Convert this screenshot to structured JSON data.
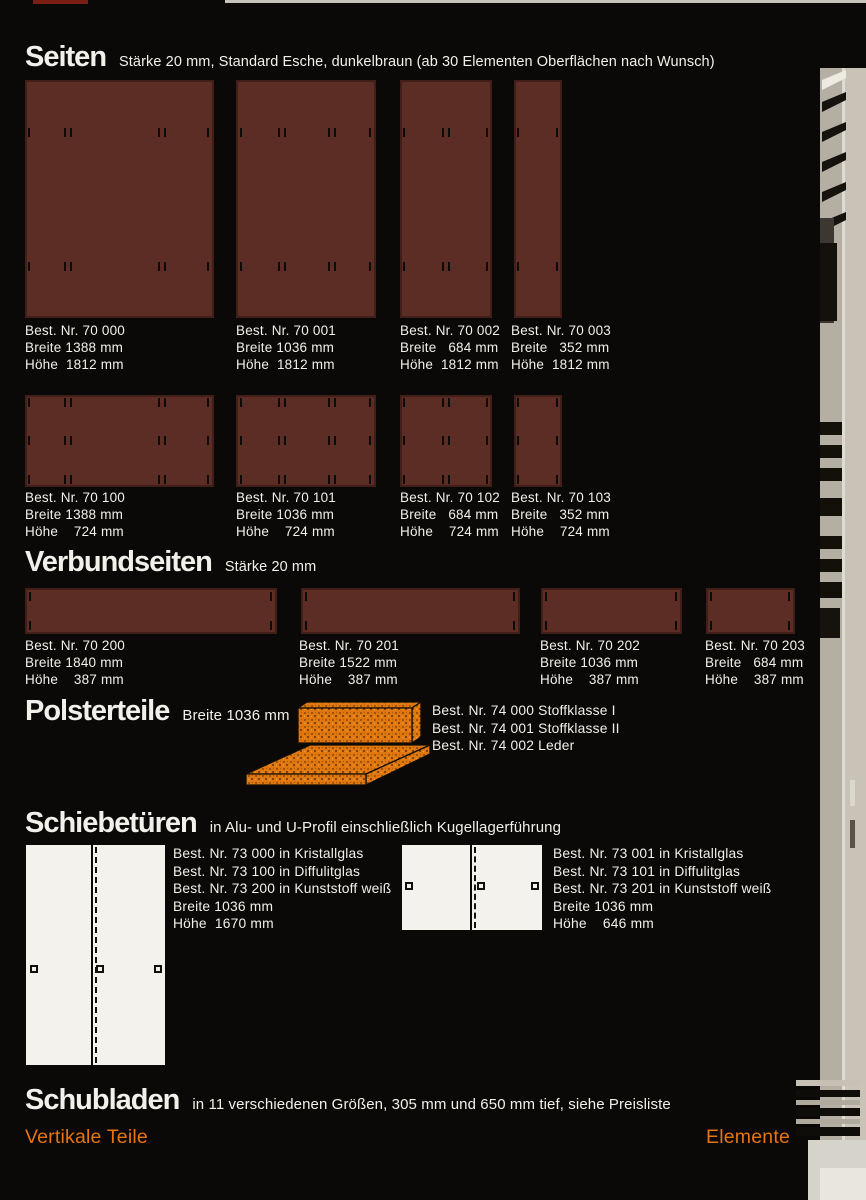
{
  "colors": {
    "background": "#0a0907",
    "panel_brown": "#5b2d24",
    "accent_orange": "#e7740e",
    "text_white": "#f2f0ea",
    "cushion_orange": "#e1780f"
  },
  "seiten": {
    "title": "Seiten",
    "subtitle": "Stärke 20 mm, Standard Esche, dunkelbraun (ab 30 Elementen Oberflächen nach Wunsch)",
    "row1": [
      {
        "nr": "Best. Nr. 70 000",
        "breite": "Breite 1388 mm",
        "hoehe": "Höhe  1812 mm"
      },
      {
        "nr": "Best. Nr. 70 001",
        "breite": "Breite 1036 mm",
        "hoehe": "Höhe  1812 mm"
      },
      {
        "nr": "Best. Nr. 70 002",
        "breite": "Breite   684 mm",
        "hoehe": "Höhe  1812 mm"
      },
      {
        "nr": "Best. Nr. 70 003",
        "breite": "Breite   352 mm",
        "hoehe": "Höhe  1812 mm"
      }
    ],
    "row2": [
      {
        "nr": "Best. Nr. 70 100",
        "breite": "Breite 1388 mm",
        "hoehe": "Höhe    724 mm"
      },
      {
        "nr": "Best. Nr. 70 101",
        "breite": "Breite 1036 mm",
        "hoehe": "Höhe    724 mm"
      },
      {
        "nr": "Best. Nr. 70 102",
        "breite": "Breite   684 mm",
        "hoehe": "Höhe    724 mm"
      },
      {
        "nr": "Best. Nr. 70 103",
        "breite": "Breite   352 mm",
        "hoehe": "Höhe    724 mm"
      }
    ]
  },
  "verbund": {
    "title": "Verbundseiten",
    "subtitle": "Stärke 20 mm",
    "items": [
      {
        "nr": "Best. Nr. 70 200",
        "breite": "Breite 1840 mm",
        "hoehe": "Höhe    387 mm"
      },
      {
        "nr": "Best. Nr. 70 201",
        "breite": "Breite 1522 mm",
        "hoehe": "Höhe    387 mm"
      },
      {
        "nr": "Best. Nr. 70 202",
        "breite": "Breite 1036 mm",
        "hoehe": "Höhe    387 mm"
      },
      {
        "nr": "Best. Nr. 70 203",
        "breite": "Breite   684 mm",
        "hoehe": "Höhe    387 mm"
      }
    ]
  },
  "polster": {
    "title": "Polsterteile",
    "subtitle": "Breite 1036 mm",
    "lines": [
      "Best. Nr. 74 000 Stoffklasse I",
      "Best. Nr. 74 001 Stoffklasse II",
      "Best. Nr. 74 002 Leder"
    ]
  },
  "schiebetueren": {
    "title": "Schiebetüren",
    "subtitle": "in Alu- und U-Profil einschließlich Kugellagerführung",
    "left_lines": [
      "Best. Nr. 73 000 in Kristallglas",
      "Best. Nr. 73 100 in Diffulitglas",
      "Best. Nr. 73 200 in Kunststoff weiß",
      "Breite 1036 mm",
      "Höhe  1670 mm"
    ],
    "right_lines": [
      "Best. Nr. 73 001 in Kristallglas",
      "Best. Nr. 73 101 in Diffulitglas",
      "Best. Nr. 73 201 in Kunststoff weiß",
      "Breite 1036 mm",
      "Höhe    646 mm"
    ]
  },
  "schubladen": {
    "title": "Schubladen",
    "subtitle": "in 11 verschiedenen Größen, 305 mm und 650 mm tief, siehe Preisliste"
  },
  "footer": {
    "left": "Vertikale Teile",
    "right": "Elemente"
  }
}
